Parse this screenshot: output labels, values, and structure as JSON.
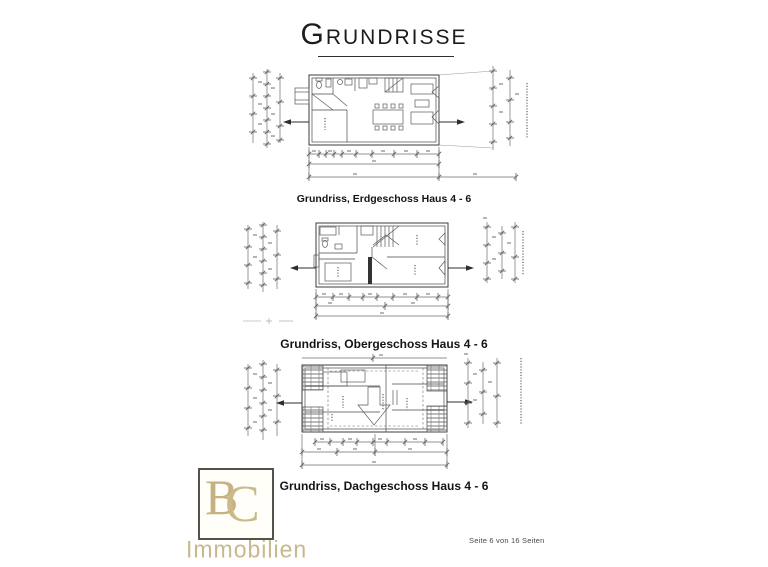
{
  "page": {
    "title": "Grundrisse",
    "footer": "Seite 6 von 16 Seiten"
  },
  "figures": [
    {
      "caption": "Grundriss, Erdgeschoss  Haus 4 - 6"
    },
    {
      "caption": "Grundriss, Obergeschoss Haus 4 - 6"
    },
    {
      "caption": "Grundriss, Dachgeschoss Haus 4 - 6"
    }
  ],
  "logo": {
    "initial_b": "B",
    "initial_c": "C",
    "name": "Immobilien",
    "color": "#c6b181"
  },
  "colors": {
    "ink": "#1c1c1c",
    "plan_line": "#3c3c3c",
    "dim_line": "#6e6e6e",
    "gold": "#c8b98c"
  }
}
